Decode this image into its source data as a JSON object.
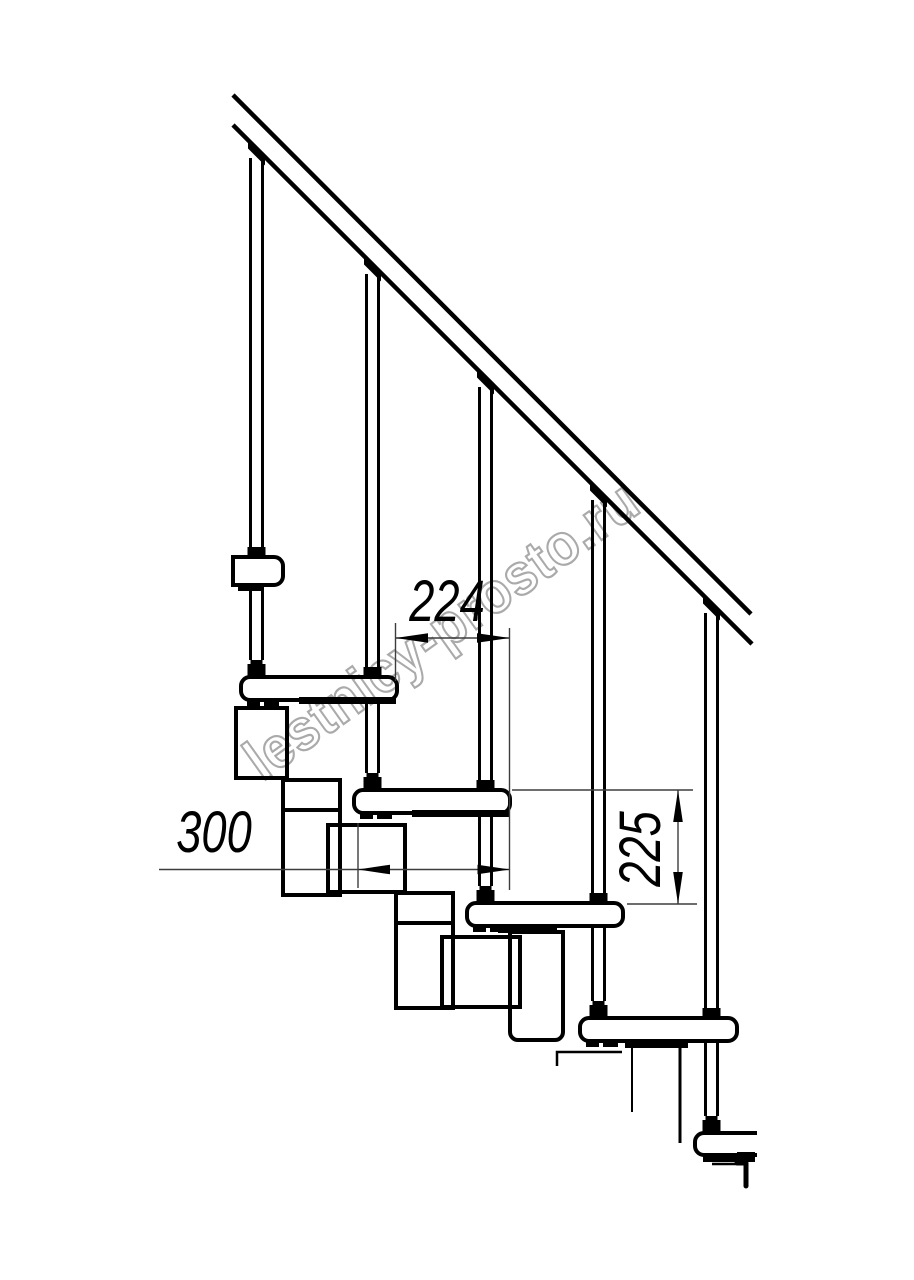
{
  "drawing": {
    "watermark": {
      "text": "lestnicy-prosto.ru",
      "color": "#aaaaaa"
    },
    "dimensions": {
      "tread_run": {
        "value": "224"
      },
      "tread_depth": {
        "value": "300"
      },
      "riser_height": {
        "value": "225"
      }
    },
    "colors": {
      "line": "#000000",
      "dim": "#3d3d3d",
      "background": "#ffffff"
    }
  }
}
